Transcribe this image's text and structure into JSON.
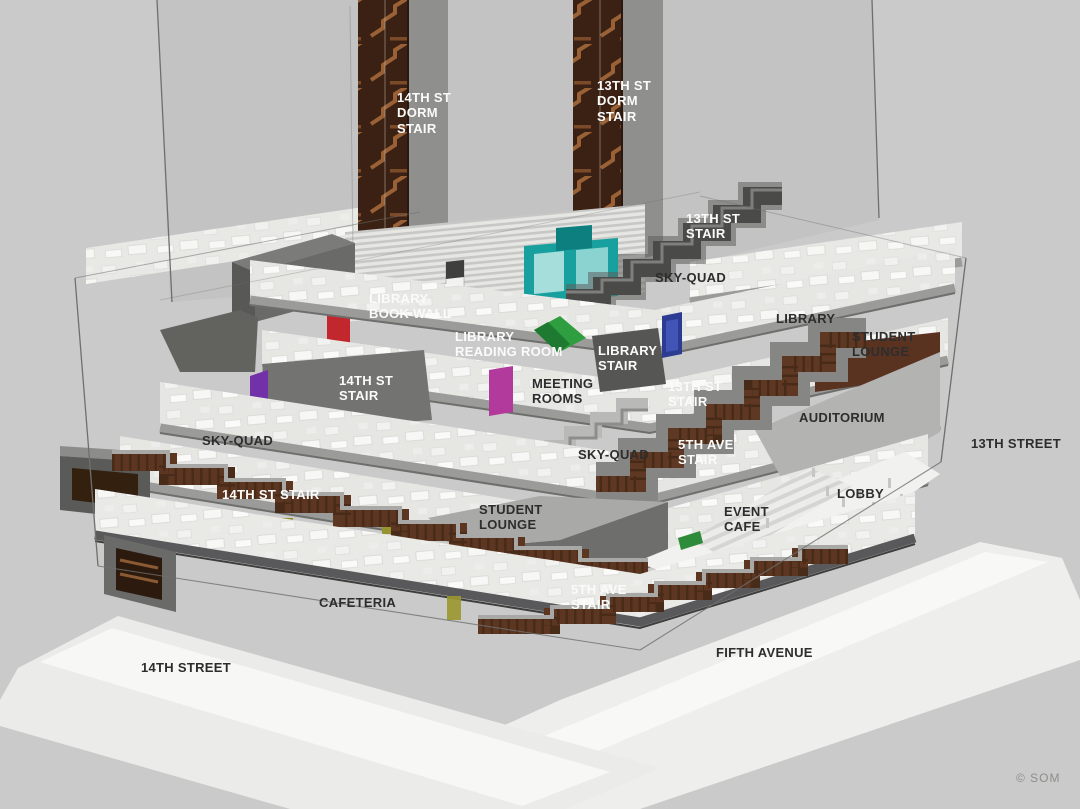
{
  "diagram": {
    "subject": "Axonometric cutaway section of a university building",
    "credit": "© SOM"
  },
  "colors": {
    "background": "#cacaca",
    "glass_shade": "#c1c1c1",
    "ground_white": "#f2f2f0",
    "floor_white": "#e6e6e3",
    "fascia_gray": "#9b9b99",
    "concrete_gray": "#787876",
    "dark_gray": "#4f4f4d",
    "stair_brown": "#5d3621",
    "stair_brown_dark": "#33200f",
    "copper": "#9a6136",
    "accent_teal": "#17a09e",
    "accent_red": "#c1272d",
    "accent_purple": "#7231a8",
    "accent_magenta": "#b23a9c",
    "accent_navy": "#2c3c92",
    "accent_green": "#2f9e41",
    "accent_olive": "#97942f",
    "label_dark": "#2d2d2d",
    "label_light": "#fbfbfa"
  },
  "labels": [
    {
      "id": "14th-st-dorm-stair",
      "text": "14TH ST\nDORM\nSTAIR",
      "tone": "light"
    },
    {
      "id": "13th-st-dorm-stair",
      "text": "13TH ST\nDORM\nSTAIR",
      "tone": "light"
    },
    {
      "id": "13th-st-stair-top",
      "text": "13TH ST\nSTAIR",
      "tone": "light"
    },
    {
      "id": "sky-quad-upper",
      "text": "SKY-QUAD",
      "tone": "dark"
    },
    {
      "id": "library-right",
      "text": "LIBRARY",
      "tone": "dark"
    },
    {
      "id": "student-lounge-right",
      "text": "STUDENT\nLOUNGE",
      "tone": "dark"
    },
    {
      "id": "library-book-wall",
      "text": "LIBRARY\nBOOK WALL",
      "tone": "light"
    },
    {
      "id": "library-reading-room",
      "text": "LIBRARY\nREADING ROOM",
      "tone": "light"
    },
    {
      "id": "library-stair",
      "text": "LIBRARY\nSTAIR",
      "tone": "light"
    },
    {
      "id": "14th-st-stair-upper",
      "text": "14TH ST\nSTAIR",
      "tone": "light"
    },
    {
      "id": "meeting-rooms",
      "text": "MEETING\nROOMS",
      "tone": "dark"
    },
    {
      "id": "13th-st-stair-mid",
      "text": "13TH ST\nSTAIR",
      "tone": "light"
    },
    {
      "id": "auditorium",
      "text": "AUDITORIUM",
      "tone": "dark"
    },
    {
      "id": "sky-quad-mid",
      "text": "SKY-QUAD",
      "tone": "dark"
    },
    {
      "id": "5th-ave-stair-mid",
      "text": "5TH AVE\nSTAIR",
      "tone": "light"
    },
    {
      "id": "13th-street",
      "text": "13TH STREET",
      "tone": "dark"
    },
    {
      "id": "lobby",
      "text": "LOBBY",
      "tone": "dark"
    },
    {
      "id": "sky-quad-left",
      "text": "SKY-QUAD",
      "tone": "dark"
    },
    {
      "id": "14th-st-stair-left",
      "text": "14TH ST STAIR",
      "tone": "light"
    },
    {
      "id": "student-lounge-mid",
      "text": "STUDENT\nLOUNGE",
      "tone": "dark"
    },
    {
      "id": "event-cafe",
      "text": "EVENT\nCAFE",
      "tone": "dark"
    },
    {
      "id": "cafeteria",
      "text": "CAFETERIA",
      "tone": "dark"
    },
    {
      "id": "5th-ave-stair-bottom",
      "text": "5TH AVE\nSTAIR",
      "tone": "light"
    },
    {
      "id": "14th-street",
      "text": "14TH STREET",
      "tone": "dark"
    },
    {
      "id": "fifth-avenue",
      "text": "FIFTH AVENUE",
      "tone": "dark"
    }
  ]
}
